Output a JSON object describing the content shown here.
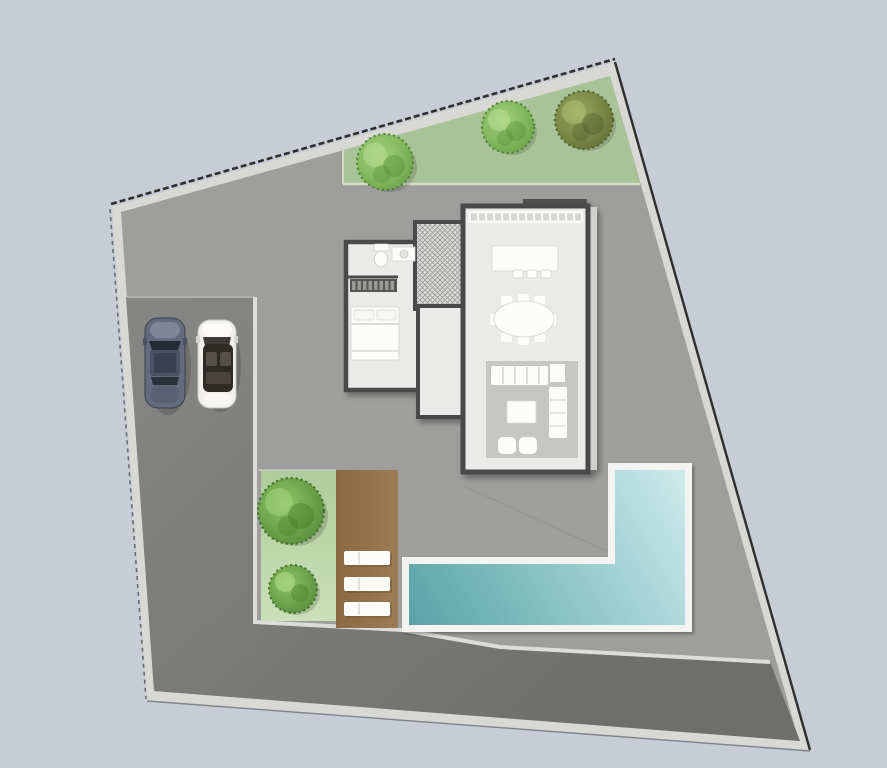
{
  "scene": {
    "kind": "architectural-site-plan",
    "plot": "irregular quadrilateral lot with light border band",
    "building": "villa floor plan: bathroom, bedroom, wardrobe, stairs, hallway, kitchen counter, kitchen island, dining table, living room suite",
    "amenities": [
      "front lawn strip with three trees",
      "driveway with two parked cars",
      "side lawn with two shrubs",
      "wooden deck with three sun loungers",
      "L-shaped swimming pool"
    ],
    "cars": [
      {
        "label": "dark coupe"
      },
      {
        "label": "white convertible"
      }
    ],
    "tree_count": 5,
    "lounger_count": 3
  },
  "colors": {
    "background": "#c7ccd6",
    "border_band": "#d8d9d4",
    "boundary_line": "#2e2e2e",
    "yard": "#9e9e9c",
    "paving_top": "#858583",
    "paving_bottom": "#6e6e6b",
    "curb": "#dcdcd8",
    "garden_green": "#a9c398",
    "garden_edge": "#d2dcc4",
    "grass_top": "#aecc9b",
    "grass_bottom": "#cbe0b8",
    "deck_left": "#8a6943",
    "deck_right": "#9c7c54",
    "pool_coping": "#f3f4f2",
    "water_deep": "#58a2a7",
    "water_mid": "#8fc7ca",
    "water_light": "#cfeaec",
    "wall": "#4a4a48",
    "floor": "#eaeae8",
    "stairs_floor": "#dcdcda",
    "rug": "#c6c6c4",
    "furniture": "#fcfcfb",
    "counter": "#f8f8f6",
    "wardrobe": "#565654",
    "eave": "#4f4f4d",
    "walkway_strip": "#d0d0ce",
    "tree_light_core": "#a5d37f",
    "tree_light_edge": "#6aa344",
    "tree_rich_core": "#8fc563",
    "tree_rich_edge": "#54893a",
    "tree_olive_core": "#9aa95e",
    "tree_olive_edge": "#606e33",
    "car_dark_body": "#646b7c",
    "car_dark_hood": "#7d8597",
    "car_dark_roof": "#4b5263",
    "car_dark_glass": "#262b36",
    "car_white_body": "#f0efeb",
    "car_white_interior": "#2e2a26",
    "car_white_seat": "#55504a"
  }
}
